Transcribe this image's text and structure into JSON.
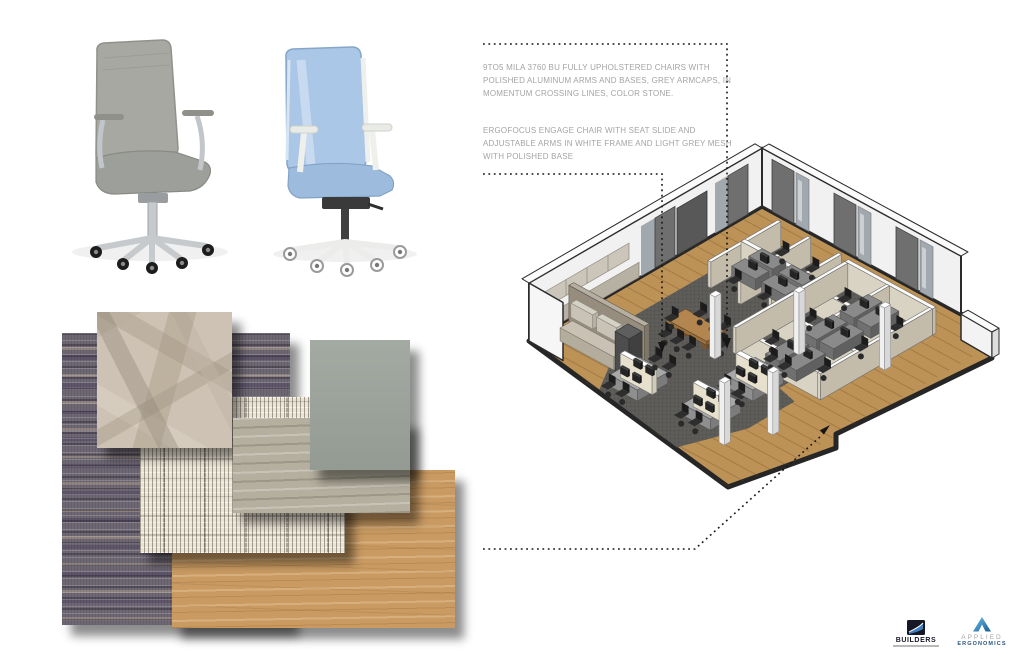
{
  "annotations": {
    "chair1_note": "9TO5 MILA 3760 BU FULLY UPHOLSTERED CHAIRS WITH POLISHED ALUMINUM ARMS AND BASES, GREY ARMCAPS, IN MOMENTUM CROSSING LINES, COLOR STONE.",
    "chair2_note": "ERGOFOCUS ENGAGE CHAIR WITH SEAT SLIDE AND ADJUSTABLE ARMS IN WHITE FRAME AND LIGHT GREY MESH WITH POLISHED BASE"
  },
  "logos": {
    "builders": {
      "name": "BUILDERS"
    },
    "applied_ergonomics": {
      "line1": "APPLIED",
      "line2": "ERGONOMICS"
    }
  },
  "materials": [
    {
      "id": "carpet-tile-striped",
      "color": "#6e6874"
    },
    {
      "id": "crossing-lines-fabric-stone",
      "color": "#cdc2b3"
    },
    {
      "id": "woven-fabric-cream",
      "color": "#eae4d4"
    },
    {
      "id": "wood-laminate-grey",
      "color": "#b4af9f"
    },
    {
      "id": "solid-fabric-sage",
      "color": "#9ba39b"
    },
    {
      "id": "oak-wood-plank",
      "color": "#c99b63"
    }
  ],
  "colors": {
    "wood_floor": "#bd9257",
    "carpet": "#5c5b58",
    "wall": "#f1f1f1",
    "wall_outline": "#2b2b2b",
    "panel_top": "#fafaf8",
    "panel_face": "#d9d3c3",
    "panel_side": "#c3bcab",
    "desk_top": "#8a8a8a",
    "desk_front": "#707070",
    "desk_side": "#606060",
    "screen_face": "#e6e0cd",
    "table_top": "#b3854f",
    "taupe_wall": "#968d7f",
    "door": "#6f6f6f",
    "glass": "#a2a9ae",
    "leader": "#161616",
    "annotation_text": "#a4a4a4",
    "chair1_body": "#a7a8a2",
    "chair2_mesh": "#aac7e7",
    "builders_navy": "#171726",
    "applied_blue_dark": "#1b5e94",
    "applied_blue_light": "#6cc0ea"
  }
}
